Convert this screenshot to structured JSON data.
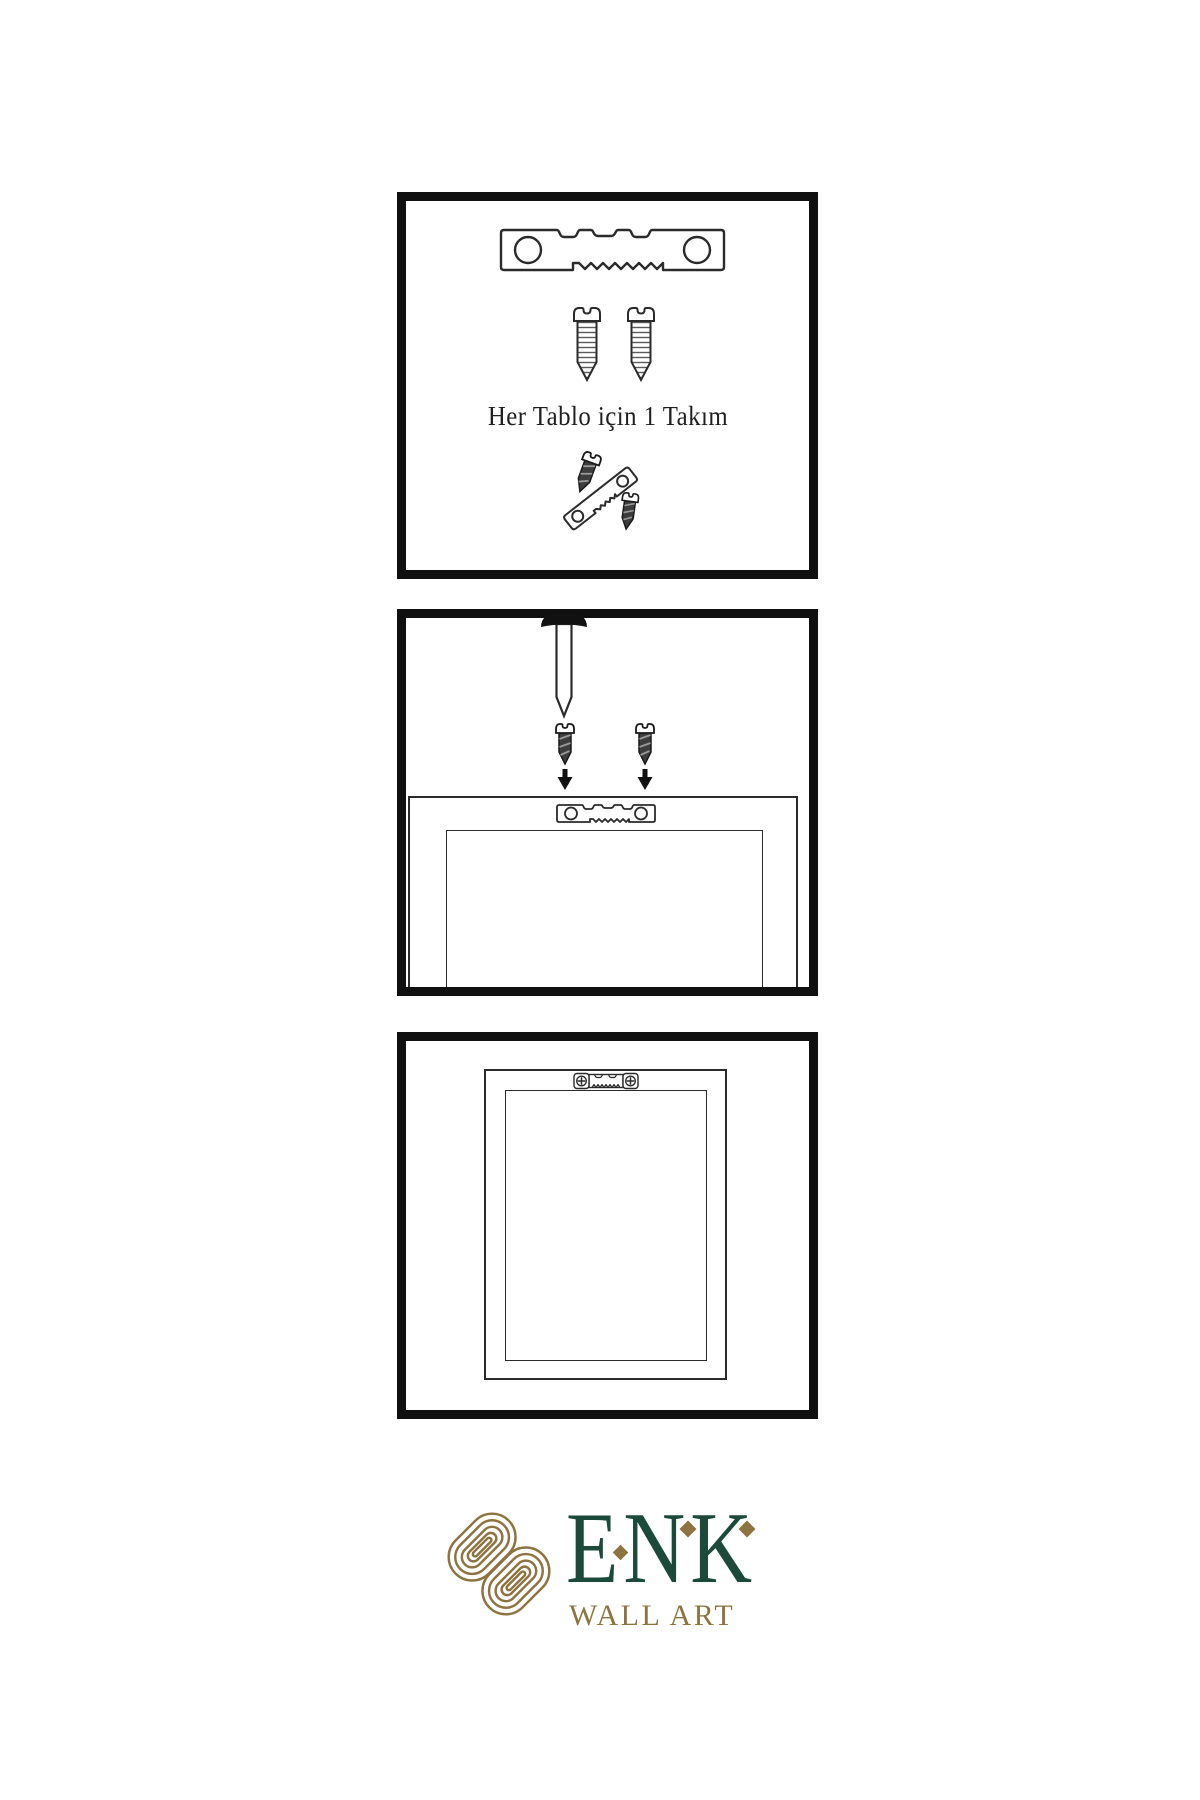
{
  "panels": {
    "kit": {
      "caption": "Her Tablo için 1 Takım",
      "icons": [
        "sawtooth-hanger-icon",
        "screw-icon",
        "screw-icon",
        "screw-into-hanger-icon"
      ]
    },
    "install": {
      "icons": [
        "nail-icon",
        "screw-down-icon",
        "screw-down-icon",
        "arrow-down-icon",
        "arrow-down-icon",
        "frame-back-outline",
        "sawtooth-hanger-small-icon"
      ]
    },
    "hung": {
      "icons": [
        "frame-front-outline",
        "sawtooth-hanger-mounted-icon"
      ]
    }
  },
  "brand": {
    "name": "ENK",
    "subtitle": "WALL ART",
    "colors": {
      "green": "#1c4a3a",
      "gold": "#8d7340"
    }
  },
  "style_colors": {
    "line": "#2b2b2b",
    "panel_border": "#101010",
    "background": "#ffffff"
  }
}
